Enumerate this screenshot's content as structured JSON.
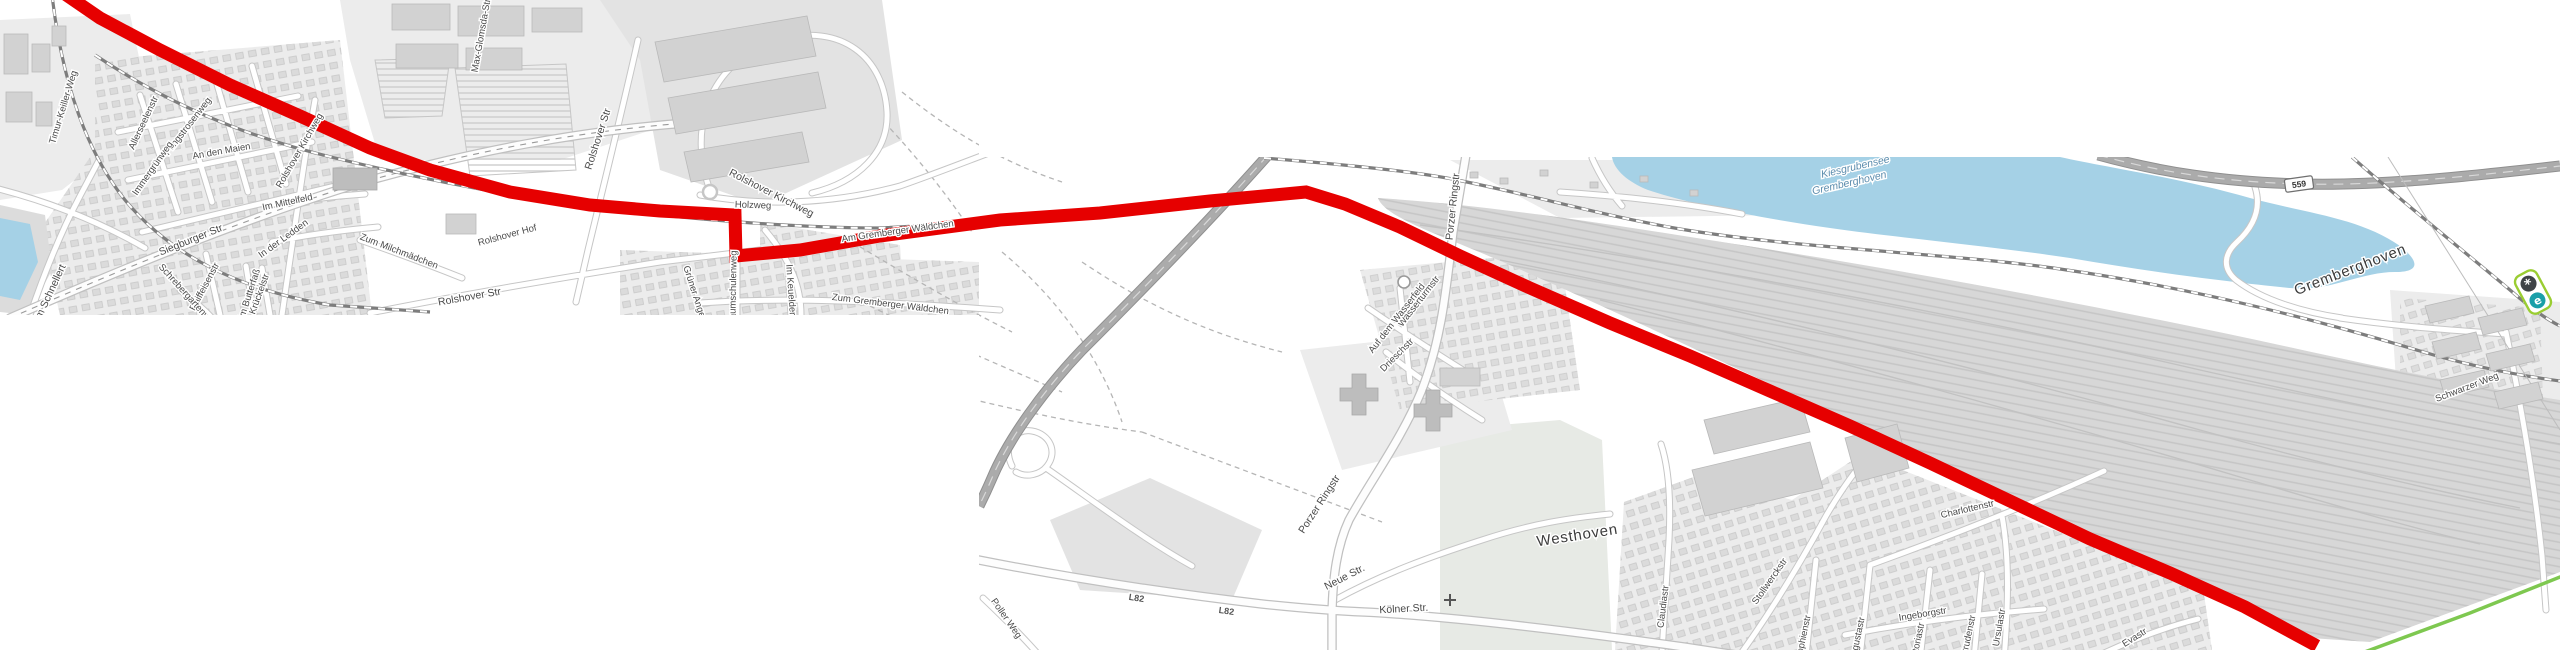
{
  "map": {
    "type": "stitched-route-map",
    "tiles": [
      {
        "name": "northwest-tile",
        "x": 0,
        "y": 0,
        "w": 979,
        "h": 315
      },
      {
        "name": "southeast-tile",
        "x": 979,
        "y": 157,
        "w": 1581,
        "h": 493
      }
    ],
    "route": {
      "color_key": "route",
      "points": "62,-8 100,18 160,50 230,85 300,116 370,148 430,170 510,192 590,205 660,211 735,215 736,256 800,250 880,236 1000,220 1100,213 1210,201 1306,192 1345,204 1400,227 1460,256 1530,288 1610,323 1690,356 1770,391 1850,426 1930,463 2010,501 2090,539 2170,573 2245,607 2317,646"
    },
    "alt_path": {
      "color_key": "green_path",
      "points": "2362,653 2470,613 2560,577"
    },
    "shield": {
      "text": "559",
      "x": 2299,
      "y": 184,
      "rot": -8
    },
    "marker_plate": {
      "x": 2533,
      "y": 292,
      "rot": -28,
      "icons": [
        {
          "glyph": "*",
          "name": "asterisk-poi-icon",
          "bg": "#3f4347"
        },
        {
          "glyph": "e",
          "name": "e-poi-icon",
          "bg": "#1a9fa8"
        }
      ]
    },
    "labels": [
      {
        "text": "Poller Kirchweg",
        "x": -42,
        "y": 212,
        "rot": -22,
        "cls": "street"
      },
      {
        "text": "Am Schnellert",
        "x": 52,
        "y": 296,
        "rot": -65,
        "cls": "street"
      },
      {
        "text": "Timur-Keiller-Weg",
        "x": 66,
        "y": 108,
        "rot": -73,
        "cls": "street-sm"
      },
      {
        "text": "Siegburger Str",
        "x": 192,
        "y": 243,
        "rot": -22,
        "cls": "street"
      },
      {
        "text": "Raiffeisenstr",
        "x": 207,
        "y": 288,
        "rot": -62,
        "cls": "street-sm"
      },
      {
        "text": "Schrebergartenweg",
        "x": 186,
        "y": 298,
        "rot": 48,
        "cls": "street-sm"
      },
      {
        "text": "Krückelstr",
        "x": 262,
        "y": 295,
        "rot": -70,
        "cls": "street-sm"
      },
      {
        "text": "Allerseelenstr",
        "x": 146,
        "y": 124,
        "rot": -65,
        "cls": "street-sm"
      },
      {
        "text": "Pfingstrosenweg",
        "x": 190,
        "y": 128,
        "rot": -52,
        "cls": "street-sm"
      },
      {
        "text": "Immergrünweg",
        "x": 155,
        "y": 170,
        "rot": -55,
        "cls": "street-sm"
      },
      {
        "text": "An den Maien",
        "x": 222,
        "y": 154,
        "rot": -10,
        "cls": "street-sm"
      },
      {
        "text": "Im Mittelfeld",
        "x": 288,
        "y": 205,
        "rot": -12,
        "cls": "street-sm"
      },
      {
        "text": "In der Ledden",
        "x": 285,
        "y": 241,
        "rot": -36,
        "cls": "street-sm"
      },
      {
        "text": "Zum Milchmädchen",
        "x": 398,
        "y": 254,
        "rot": 21,
        "cls": "street-sm"
      },
      {
        "text": "Im Butterfaß",
        "x": 252,
        "y": 295,
        "rot": -72,
        "cls": "street-sm"
      },
      {
        "text": "Rolshover Str",
        "x": 470,
        "y": 300,
        "rot": -10,
        "cls": "street"
      },
      {
        "text": "Rolshover Str",
        "x": 601,
        "y": 140,
        "rot": -72,
        "cls": "street"
      },
      {
        "text": "Rolshover Hof",
        "x": 508,
        "y": 238,
        "rot": -15,
        "cls": "street-sm"
      },
      {
        "text": "Rolshover Kirchweg",
        "x": 302,
        "y": 152,
        "rot": -60,
        "cls": "street-sm"
      },
      {
        "text": "Rolshover Kirchweg",
        "x": 770,
        "y": 196,
        "rot": 27,
        "cls": "street"
      },
      {
        "text": "Max-Glomsda-Str",
        "x": 484,
        "y": 36,
        "rot": -80,
        "cls": "street-sm"
      },
      {
        "text": "Holzweg",
        "x": 753,
        "y": 208,
        "rot": 2,
        "cls": "street-sm"
      },
      {
        "text": "Grüner Anger",
        "x": 692,
        "y": 294,
        "rot": 72,
        "cls": "street-sm"
      },
      {
        "text": "Baumschulenweg",
        "x": 736,
        "y": 288,
        "rot": -89,
        "cls": "street-sm"
      },
      {
        "text": "Im Keuelder",
        "x": 788,
        "y": 290,
        "rot": 86,
        "cls": "street-sm"
      },
      {
        "text": "Zum Gremberger Wäldchen",
        "x": 890,
        "y": 307,
        "rot": 7,
        "cls": "street-sm"
      },
      {
        "text": "Am Gremberger Wäldchen",
        "x": 898,
        "y": 234,
        "rot": -8,
        "cls": "street-sm"
      },
      {
        "text": "Porzer Ringstr",
        "x": 1456,
        "y": 207,
        "rot": -84,
        "cls": "street"
      },
      {
        "text": "Porzer Ringstr",
        "x": 1322,
        "y": 506,
        "rot": -57,
        "cls": "street"
      },
      {
        "text": "Neue Str.",
        "x": 1346,
        "y": 580,
        "rot": -27,
        "cls": "street"
      },
      {
        "text": "Kölner Str.",
        "x": 1404,
        "y": 612,
        "rot": -3,
        "cls": "street"
      },
      {
        "text": "L82",
        "x": 1136,
        "y": 601,
        "rot": 9,
        "cls": "ref"
      },
      {
        "text": "L82",
        "x": 1226,
        "y": 614,
        "rot": 8,
        "cls": "ref"
      },
      {
        "text": "Poller Weg",
        "x": 1004,
        "y": 620,
        "rot": 55,
        "cls": "street-sm"
      },
      {
        "text": "Wasserturmstr",
        "x": 1421,
        "y": 303,
        "rot": -52,
        "cls": "street-sm"
      },
      {
        "text": "Auf dem Wasserfeld",
        "x": 1399,
        "y": 320,
        "rot": -52,
        "cls": "street-sm"
      },
      {
        "text": "Drieschstr",
        "x": 1399,
        "y": 357,
        "rot": -45,
        "cls": "street-sm"
      },
      {
        "text": "Westhoven",
        "x": 1578,
        "y": 540,
        "rot": -9,
        "cls": "place"
      },
      {
        "text": "Charlottenstr",
        "x": 1968,
        "y": 512,
        "rot": -13,
        "cls": "street-sm"
      },
      {
        "text": "Stollwerckstr",
        "x": 1772,
        "y": 583,
        "rot": -55,
        "cls": "street-sm"
      },
      {
        "text": "Ingeborgstr",
        "x": 1923,
        "y": 617,
        "rot": -9,
        "cls": "street-sm"
      },
      {
        "text": "Claudiastr",
        "x": 1666,
        "y": 607,
        "rot": -83,
        "cls": "street-sm"
      },
      {
        "text": "Sophienstr",
        "x": 1806,
        "y": 638,
        "rot": -78,
        "cls": "street-sm"
      },
      {
        "text": "Augustastr",
        "x": 1860,
        "y": 640,
        "rot": -78,
        "cls": "street-sm"
      },
      {
        "text": "Viktoriastr",
        "x": 1920,
        "y": 644,
        "rot": -78,
        "cls": "street-sm"
      },
      {
        "text": "Gertrudenstr",
        "x": 1970,
        "y": 642,
        "rot": -78,
        "cls": "street-sm"
      },
      {
        "text": "Ursulastr",
        "x": 2002,
        "y": 628,
        "rot": -80,
        "cls": "street-sm"
      },
      {
        "text": "Evastr",
        "x": 2136,
        "y": 640,
        "rot": -32,
        "cls": "street-sm"
      },
      {
        "text": "Gremberghoven",
        "x": 2352,
        "y": 274,
        "rot": -21,
        "cls": "place"
      },
      {
        "text": "Kiesgrubensee",
        "x": 1856,
        "y": 170,
        "rot": -13,
        "cls": "water-lbl"
      },
      {
        "text": "Gremberghoven",
        "x": 1850,
        "y": 186,
        "rot": -13,
        "cls": "water-lbl"
      },
      {
        "text": "Schwarzer Weg",
        "x": 2468,
        "y": 390,
        "rot": -21,
        "cls": "street-sm"
      }
    ]
  },
  "colors": {
    "route": "#e60000",
    "green_path": "#7ec850",
    "water": "#a5d1e6",
    "plate_green": "#9acd32",
    "poi_dark": "#3f4347",
    "poi_teal": "#1a9fa8",
    "land": "#ececec",
    "rail": "#7d7d7d",
    "yard": "#d7d7d7"
  }
}
